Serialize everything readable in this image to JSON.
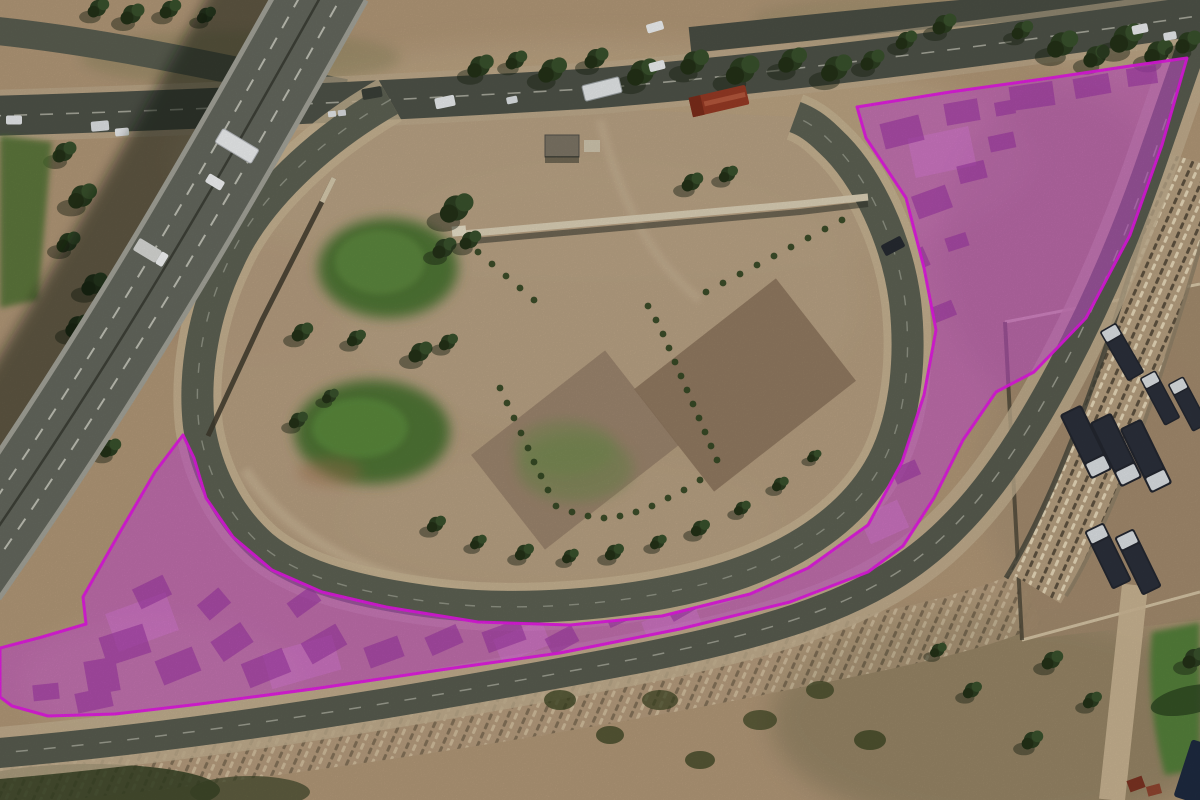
{
  "meta": {
    "view_type": "satellite-aerial-photo",
    "description": "Aerial imagery of a highway loop interchange with informal settlement areas highlighted in magenta",
    "width_px": 1200,
    "height_px": 800
  },
  "overlay": {
    "highlight_fill": "#c84fd0",
    "highlight_fill_opacity": 0.58,
    "highlight_stroke": "#e319e3",
    "highlight_stroke_width": 3,
    "regions": [
      {
        "name": "highlighted-settlement-area",
        "shape": "polygon",
        "points": [
          [
            183,
            435
          ],
          [
            194,
            458
          ],
          [
            206,
            498
          ],
          [
            233,
            537
          ],
          [
            272,
            570
          ],
          [
            322,
            592
          ],
          [
            386,
            607
          ],
          [
            478,
            622
          ],
          [
            570,
            625
          ],
          [
            662,
            616
          ],
          [
            750,
            594
          ],
          [
            808,
            568
          ],
          [
            868,
            525
          ],
          [
            902,
            462
          ],
          [
            924,
            395
          ],
          [
            936,
            330
          ],
          [
            924,
            268
          ],
          [
            906,
            198
          ],
          [
            866,
            138
          ],
          [
            857,
            107
          ],
          [
            950,
            92
          ],
          [
            1050,
            78
          ],
          [
            1130,
            66
          ],
          [
            1187,
            58
          ],
          [
            1162,
            145
          ],
          [
            1130,
            235
          ],
          [
            1086,
            318
          ],
          [
            1034,
            372
          ],
          [
            996,
            392
          ],
          [
            963,
            440
          ],
          [
            934,
            498
          ],
          [
            903,
            546
          ],
          [
            868,
            572
          ],
          [
            790,
            602
          ],
          [
            680,
            629
          ],
          [
            560,
            653
          ],
          [
            440,
            670
          ],
          [
            320,
            688
          ],
          [
            200,
            704
          ],
          [
            115,
            714
          ],
          [
            48,
            716
          ],
          [
            12,
            706
          ],
          [
            0,
            697
          ],
          [
            0,
            648
          ],
          [
            42,
            637
          ],
          [
            86,
            624
          ],
          [
            83,
            597
          ],
          [
            120,
            532
          ],
          [
            155,
            472
          ]
        ]
      }
    ]
  },
  "features": {
    "overpass": "elevated highway crossing diagonally at upper left",
    "top_road": "arterial road with traffic along the top edge",
    "loop_ramp": "teardrop loop ramp enclosing a dirt park",
    "park_interior": "dirt roundabout interior with grass mounds, garden plots and trees",
    "west_highlight": "settlement wedge between overpass and loop ramp (highlighted)",
    "east_highlight": "settlement triangle east of the loop ramp (highlighted)",
    "south_highlight": "settlement strip between loop ramp and outer road (highlighted)",
    "truck_depot": "truck parking yard on the right side",
    "rocky_embankment": "stone-textured embankment strips along the outer road",
    "grass_field": "green field at the lower right edge"
  },
  "palette": {
    "terrain_tan": "#b29878",
    "terrain_light": "#c6b292",
    "asphalt": "#5c6052",
    "shoulder_dirt": "#c3b091",
    "grass_green": "#527636",
    "tree_green": "#2c3e21",
    "bridge_gray": "#64685e",
    "truck_dark": "#232730",
    "red_truck": "#963a24"
  }
}
